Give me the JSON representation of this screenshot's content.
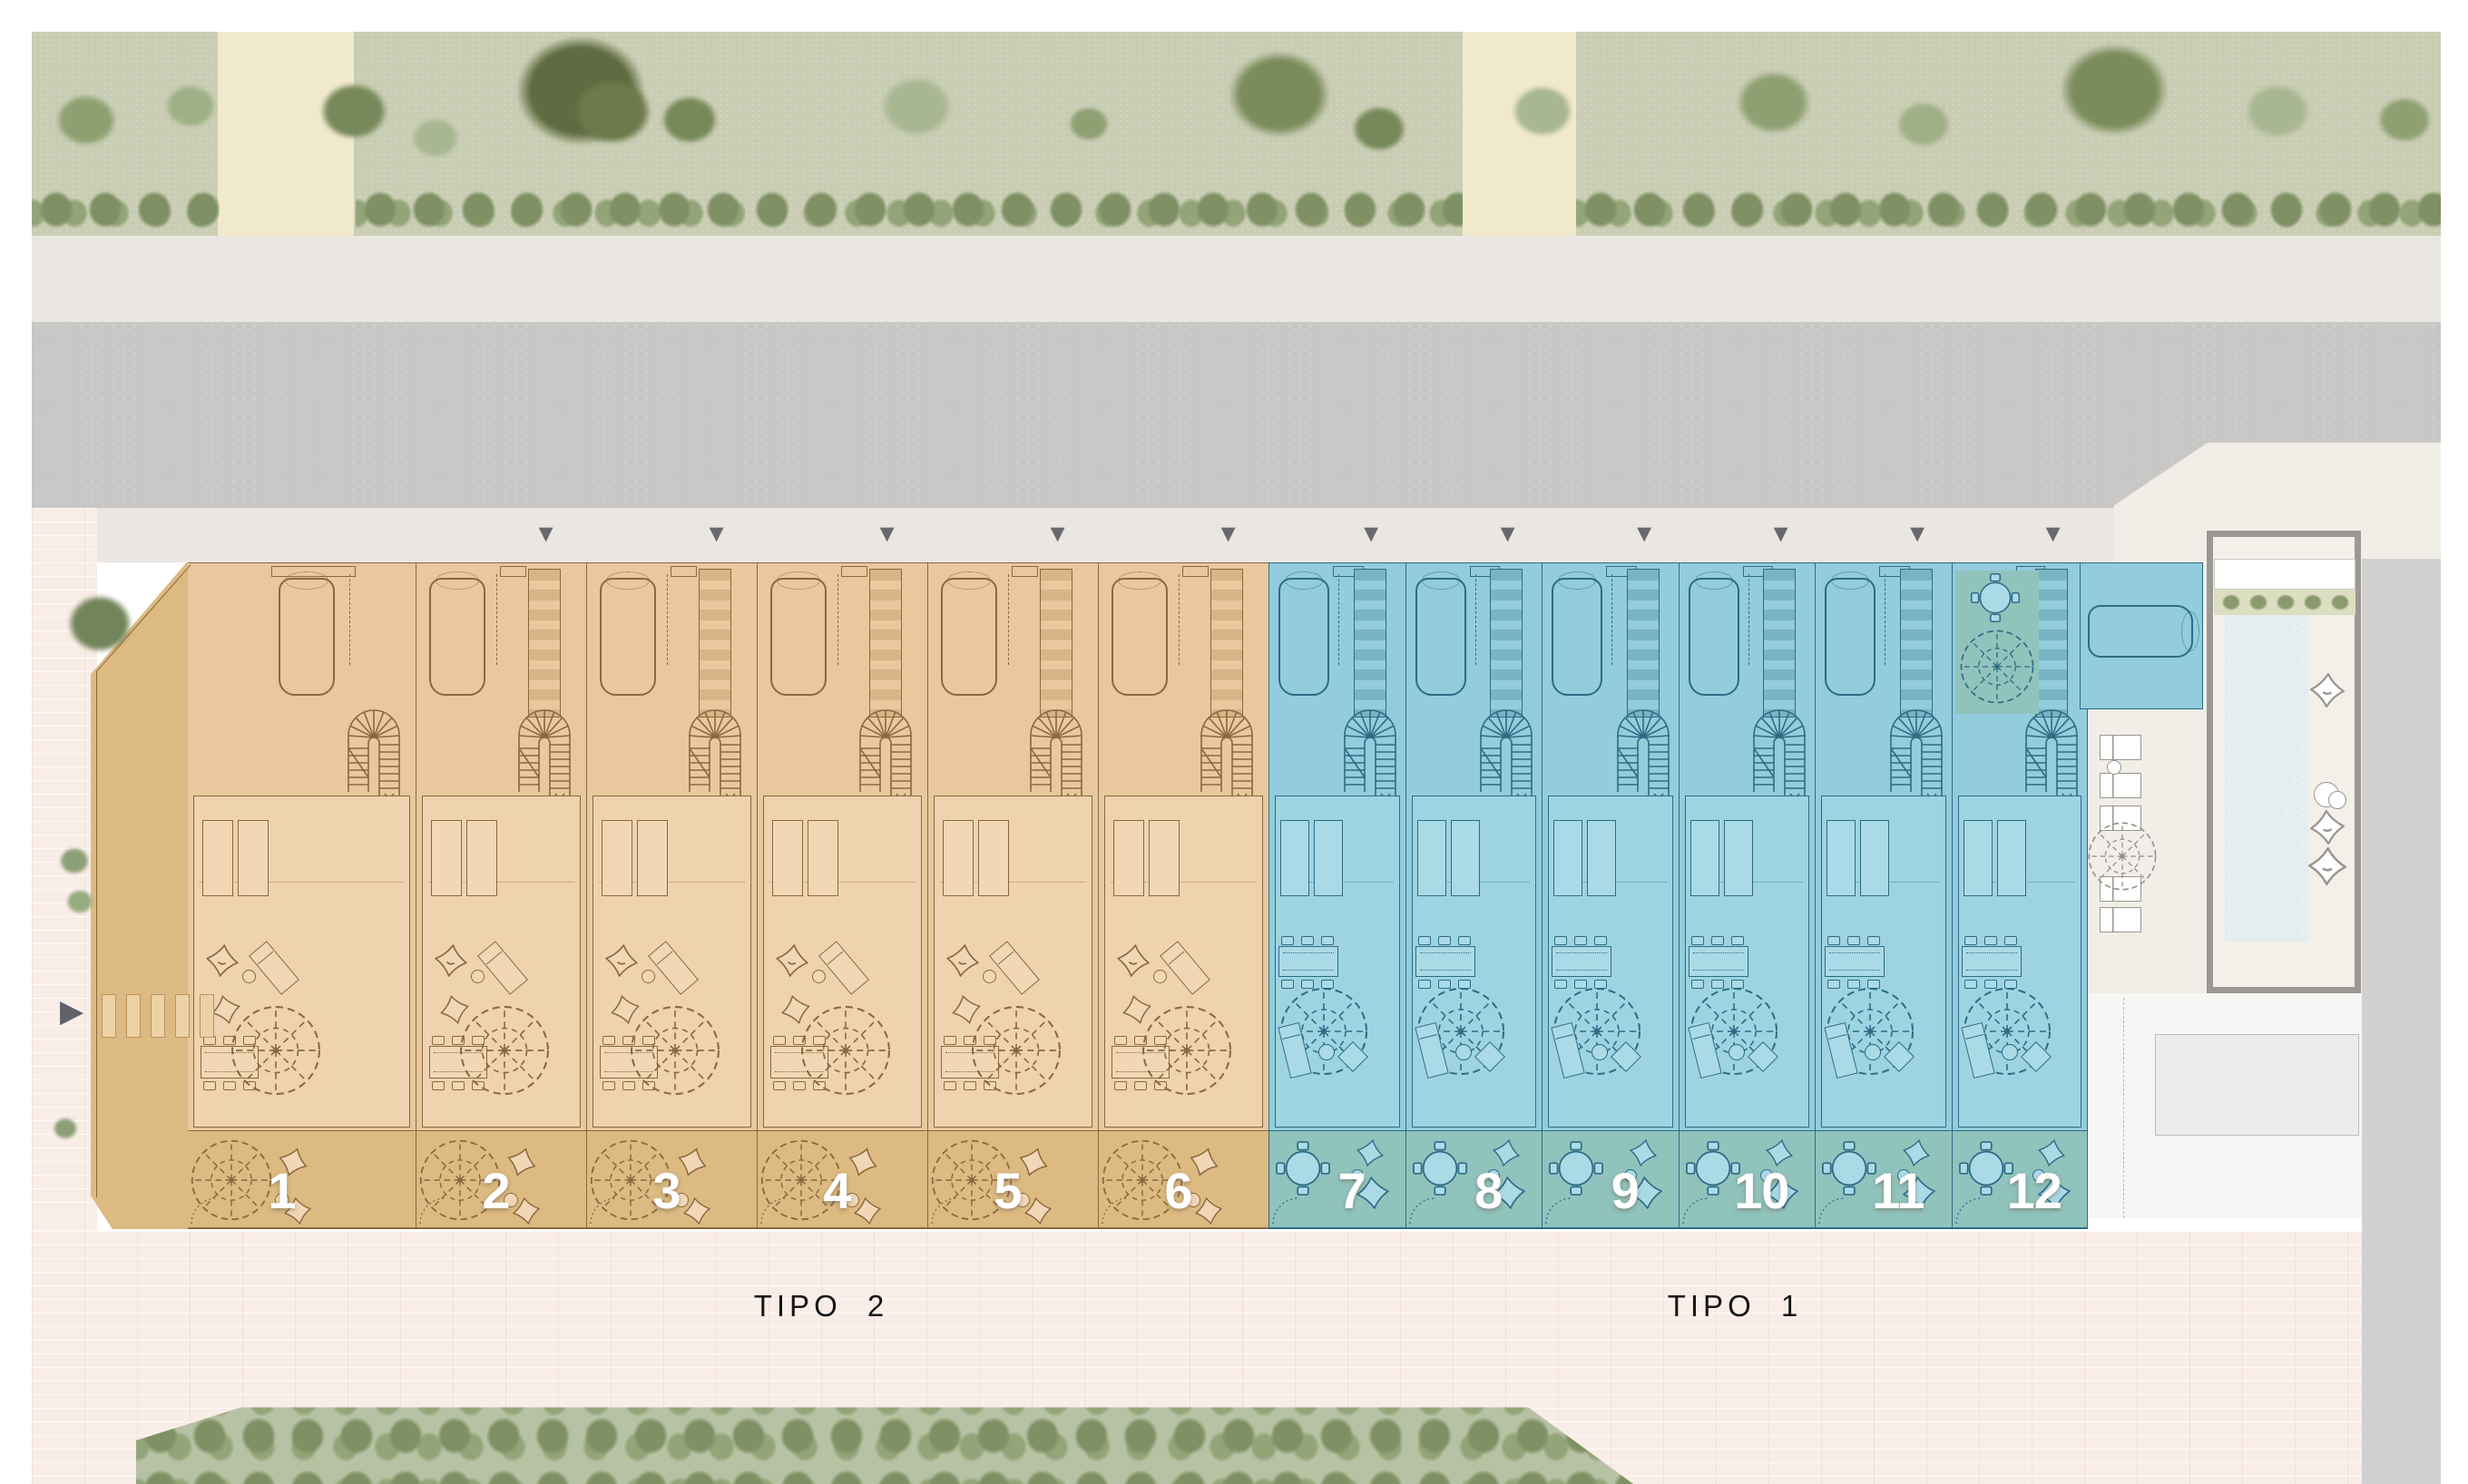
{
  "plan": {
    "type_labels": {
      "tipo2": "TIPO 2",
      "tipo1": "TIPO 1"
    },
    "units": [
      {
        "number": "1",
        "type": "TIPO 2",
        "ladder": false,
        "parking": true,
        "patio": false
      },
      {
        "number": "2",
        "type": "TIPO 2",
        "ladder": true,
        "parking": true,
        "patio": false
      },
      {
        "number": "3",
        "type": "TIPO 2",
        "ladder": true,
        "parking": true,
        "patio": false
      },
      {
        "number": "4",
        "type": "TIPO 2",
        "ladder": true,
        "parking": true,
        "patio": false
      },
      {
        "number": "5",
        "type": "TIPO 2",
        "ladder": true,
        "parking": true,
        "patio": false
      },
      {
        "number": "6",
        "type": "TIPO 2",
        "ladder": true,
        "parking": true,
        "patio": false
      },
      {
        "number": "7",
        "type": "TIPO 1",
        "ladder": true,
        "parking": true,
        "patio": false
      },
      {
        "number": "8",
        "type": "TIPO 1",
        "ladder": true,
        "parking": true,
        "patio": false
      },
      {
        "number": "9",
        "type": "TIPO 1",
        "ladder": true,
        "parking": true,
        "patio": false
      },
      {
        "number": "10",
        "type": "TIPO 1",
        "ladder": true,
        "parking": true,
        "patio": false
      },
      {
        "number": "11",
        "type": "TIPO 1",
        "ladder": true,
        "parking": true,
        "patio": false
      },
      {
        "number": "12",
        "type": "TIPO 1",
        "ladder": true,
        "parking": true,
        "patio": true
      }
    ],
    "icons": {
      "access_marker": "▼",
      "entrance_arrow": "▶"
    },
    "colors": {
      "tipo2_accent": "#e9c89e",
      "tipo2_terrace": "#efd3ae",
      "tipo2_garden": "#dcba81",
      "tipo2_line": "#8a6840",
      "tipo2_furniture": "#f1d7b5",
      "tipo2_rung": "#d8b586",
      "tipo1_accent": "#93ccdc",
      "tipo1_terrace": "#9ed4e2",
      "tipo1_garden": "#90c3bc",
      "tipo1_line": "#2d6c85",
      "tipo1_furniture": "#abdae7",
      "tipo1_rung": "#79b4c5",
      "road": "#c9c7c6",
      "sidewalk": "#eae7e2",
      "grass": "#c9cdb3",
      "hedge": "#7f9164",
      "hedge_light": "#93a578",
      "path": "#f1e9cc",
      "paving": "#f9ede7",
      "apron": "#f1ede7",
      "pool_deck": "#f3efe9",
      "pool_water": "#e4edef",
      "wall": "#9c9894",
      "gray_band": "#d2d1cf",
      "service_fill": "#ececeb",
      "service_line": "#bdbbb9",
      "below_pool": "#f7f6f4",
      "white_line": "#98958f",
      "marker": "#67696e",
      "number": "#ffffff",
      "label": "#161616"
    }
  }
}
